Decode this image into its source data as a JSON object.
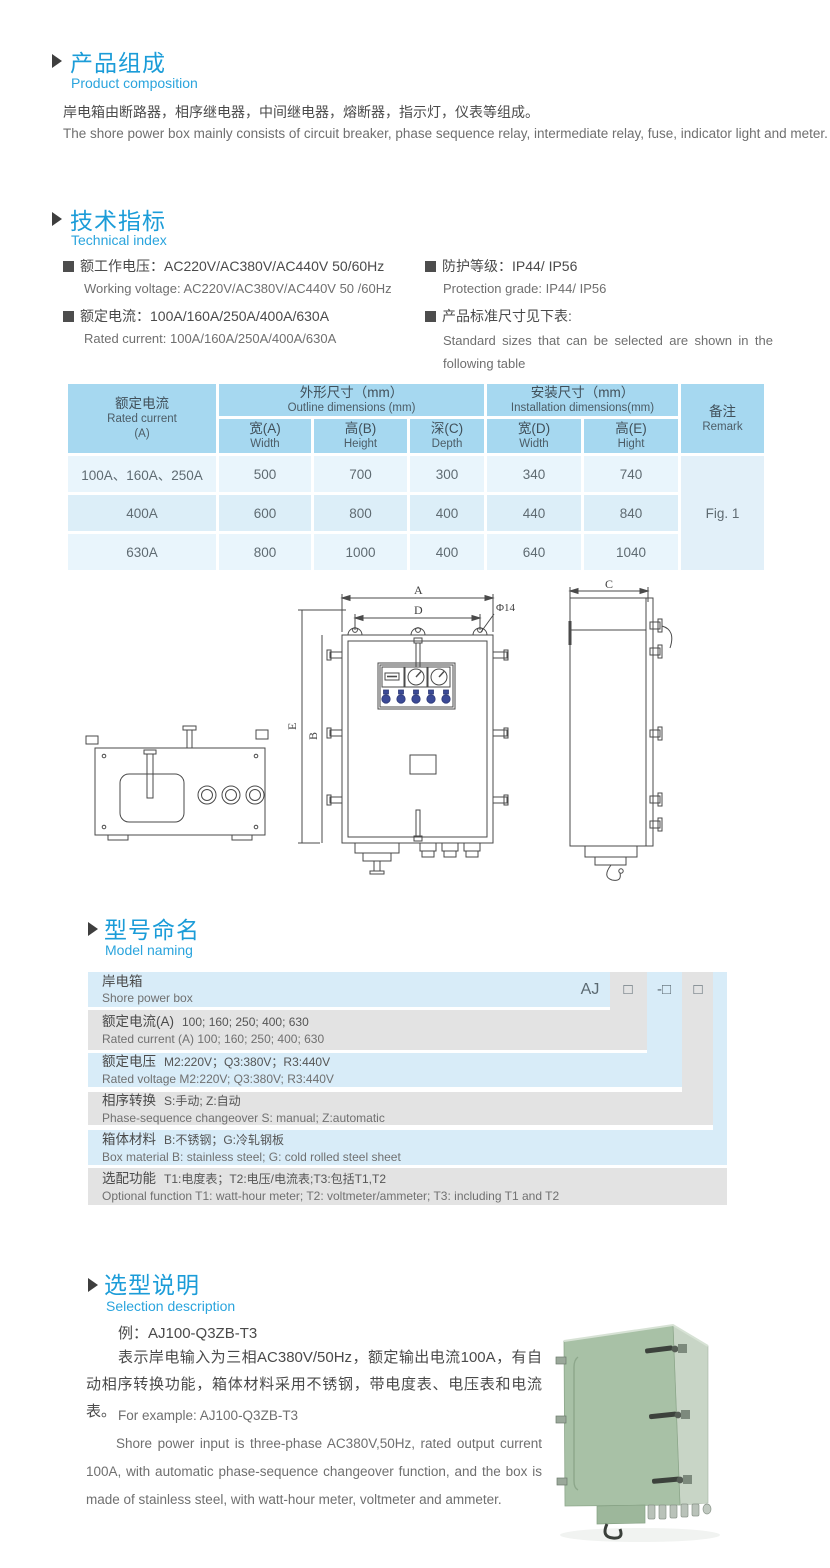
{
  "colors": {
    "accent_blue": "#1b9cd8",
    "sub_blue": "#2aa4dd",
    "table_header_blue": "#a6d8f0",
    "row_blue": "#e9f5fc",
    "row_blue_alt": "#dceef8",
    "naming_blue": "#d8ecf8",
    "naming_gray": "#e3e3e3",
    "photo_green_front": "#a8c1a6",
    "photo_green_side": "#c8d5c6"
  },
  "composition": {
    "title_cn": "产品组成",
    "title_en": "Product  composition",
    "body_cn": "岸电箱由断路器，相序继电器，中间继电器，熔断器，指示灯，仪表等组成。",
    "body_en": "The shore power box mainly consists of circuit breaker, phase sequence relay, intermediate relay, fuse, indicator light and meter."
  },
  "technical": {
    "title_cn": "技术指标",
    "title_en": "Technical index",
    "specs": [
      {
        "cn": "额工作电压：AC220V/AC380V/AC440V  50/60Hz",
        "en": "Working voltage: AC220V/AC380V/AC440V 50 /60Hz"
      },
      {
        "cn": "额定电流：100A/160A/250A/400A/630A",
        "en": "Rated current: 100A/160A/250A/400A/630A"
      },
      {
        "cn": "防护等级：IP44/ IP56",
        "en": "Protection grade: IP44/ IP56"
      },
      {
        "cn": "产品标准尺寸见下表:",
        "en": "Standard sizes that can be selected are shown in the following table"
      }
    ]
  },
  "dim_table": {
    "col1": {
      "cn": "额定电流",
      "en": "Rated current",
      "unit": "(A)"
    },
    "group1": {
      "cn": "外形尺寸（mm）",
      "en": "Outline dimensions (mm)"
    },
    "group2": {
      "cn": "安装尺寸（mm）",
      "en": "Installation dimensions(mm)"
    },
    "remark": {
      "cn": "备注",
      "en": "Remark"
    },
    "subcols": [
      {
        "cn": "宽(A)",
        "en": "Width"
      },
      {
        "cn": "高(B)",
        "en": "Height"
      },
      {
        "cn": "深(C)",
        "en": "Depth"
      },
      {
        "cn": "宽(D)",
        "en": "Width"
      },
      {
        "cn": "高(E)",
        "en": "Hight"
      }
    ],
    "rows": [
      {
        "current": "100A、160A、250A",
        "values": [
          "500",
          "700",
          "300",
          "340",
          "740"
        ]
      },
      {
        "current": "400A",
        "values": [
          "600",
          "800",
          "400",
          "440",
          "840"
        ]
      },
      {
        "current": "630A",
        "values": [
          "800",
          "1000",
          "400",
          "640",
          "1040"
        ]
      }
    ],
    "remark_value": "Fig. 1"
  },
  "drawings": {
    "labels": {
      "a": "A",
      "b": "B",
      "c": "C",
      "d": "D",
      "e": "E",
      "dia": "Φ14"
    }
  },
  "naming": {
    "title_cn": "型号命名",
    "title_en": "Model naming",
    "code": {
      "prefix": "AJ",
      "box1": "□",
      "box2": "-□",
      "box3": "□"
    },
    "rows": [
      {
        "cn": "岸电箱",
        "en": "Shore power box"
      },
      {
        "cn": "额定电流(A)",
        "detail": "100; 160; 250; 400; 630",
        "en": "Rated current (A) 100; 160; 250; 400; 630"
      },
      {
        "cn": "额定电压",
        "detail": "M2:220V；Q3:380V；R3:440V",
        "en": "Rated voltage  M2:220V;  Q3:380V;  R3:440V"
      },
      {
        "cn": "相序转换",
        "detail": "S:手动; Z:自动",
        "en": "Phase-sequence changeover  S: manual;  Z:automatic"
      },
      {
        "cn": "箱体材料",
        "detail": "B:不锈钢；G:冷轧钢板",
        "en": "Box material   B: stainless steel; G: cold rolled steel sheet"
      },
      {
        "cn": "选配功能",
        "detail": "T1:电度表；T2:电压/电流表;T3:包括T1,T2",
        "en": "Optional function  T1: watt-hour meter; T2: voltmeter/ammeter; T3: including T1 and T2"
      }
    ]
  },
  "selection": {
    "title_cn": "选型说明",
    "title_en": "Selection description",
    "example_cn": "例：AJ100-Q3ZB-T3",
    "para_cn": "表示岸电输入为三相AC380V/50Hz，额定输出电流100A，有自动相序转换功能，箱体材料采用不锈钢，带电度表、电压表和电流表。",
    "example_en": "For example: AJ100-Q3ZB-T3",
    "para_en": "Shore power input is three-phase AC380V,50Hz, rated output current 100A, with automatic phase-sequence changeover function, and the box is made of stainless steel, with watt-hour meter, voltmeter and ammeter."
  }
}
